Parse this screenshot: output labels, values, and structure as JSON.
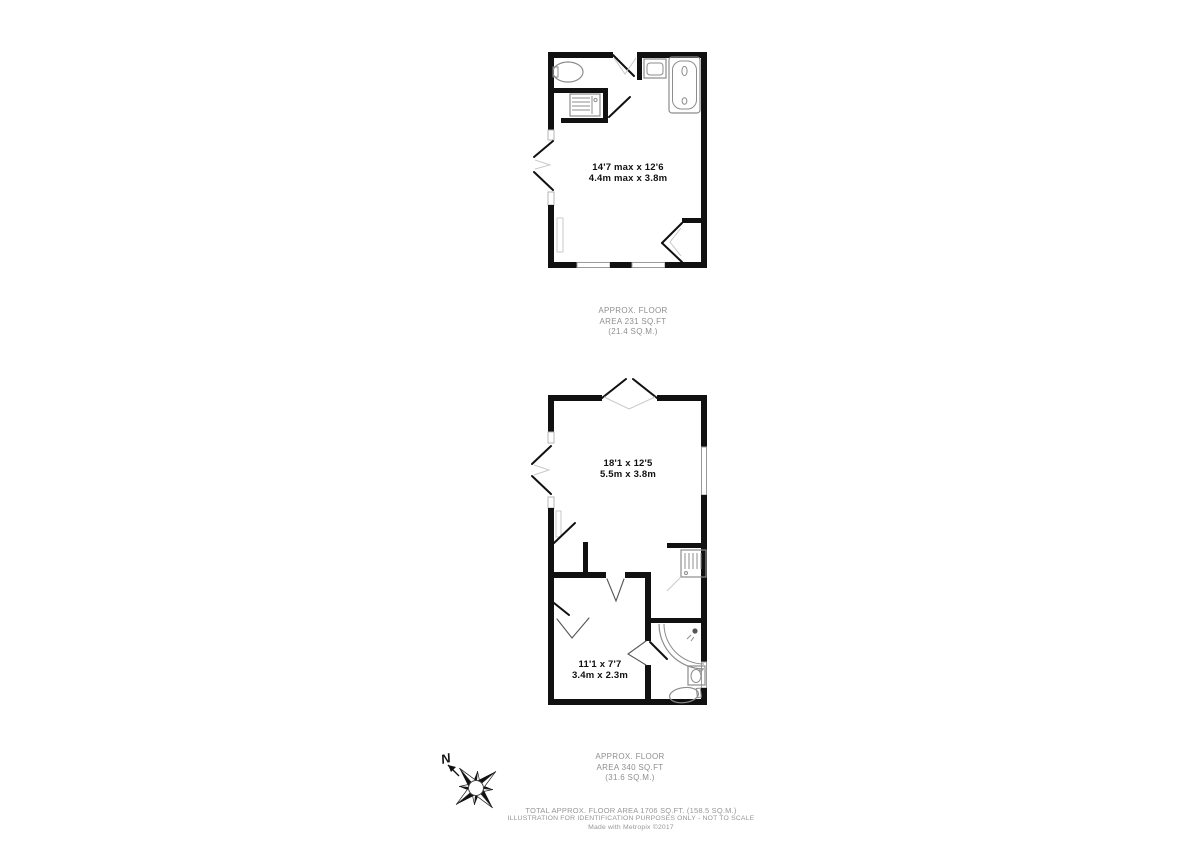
{
  "colors": {
    "background": "#ffffff",
    "wall": "#111111",
    "fixture_outline": "#8c8c8c",
    "room_label_text": "#111111",
    "muted_text": "#979797"
  },
  "floor_1": {
    "room": {
      "dim_imperial": "14'7 max x 12'6",
      "dim_metric": "4.4m max x 3.8m"
    },
    "area_note": {
      "line1": "APPROX. FLOOR",
      "line2": "AREA 231 SQ.FT",
      "line3": "(21.4 SQ.M.)"
    }
  },
  "floor_2": {
    "room_main": {
      "dim_imperial": "18'1 x 12'5",
      "dim_metric": "5.5m x 3.8m"
    },
    "room_second": {
      "dim_imperial": "11'1 x 7'7",
      "dim_metric": "3.4m x 2.3m"
    },
    "area_note": {
      "line1": "APPROX. FLOOR",
      "line2": "AREA 340 SQ.FT",
      "line3": "(31.6 SQ.M.)"
    }
  },
  "compass": {
    "north_label": "N"
  },
  "footer": {
    "line1": "TOTAL APPROX. FLOOR AREA 1706 SQ.FT. (158.5 SQ.M.)",
    "line2": "ILLUSTRATION FOR IDENTIFICATION PURPOSES ONLY - NOT TO SCALE",
    "line3": "Made with Metropix ©2017"
  }
}
